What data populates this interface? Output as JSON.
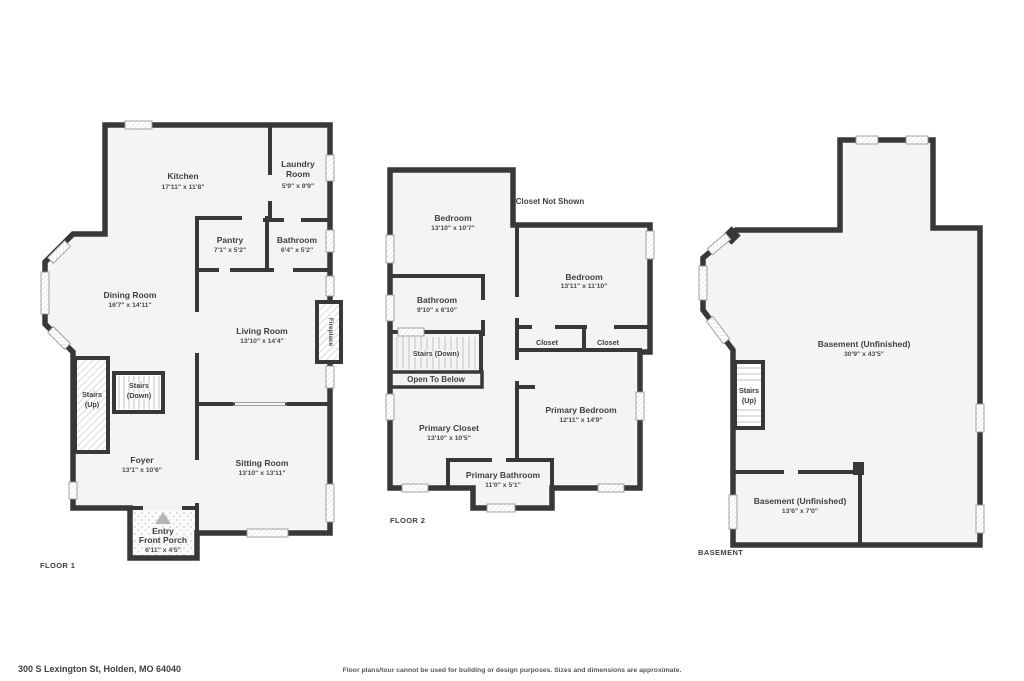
{
  "floor1": {
    "caption": "FLOOR 1",
    "kitchen": {
      "name": "Kitchen",
      "dims": "17'11\" x 11'8\""
    },
    "laundry": {
      "line1": "Laundry",
      "line2": "Room",
      "dims": "5'9\" x 9'9\""
    },
    "pantry": {
      "name": "Pantry",
      "dims": "7'1\" x 5'2\""
    },
    "bathroom": {
      "name": "Bathroom",
      "dims": "6'4\" x 5'2\""
    },
    "dining": {
      "name": "Dining Room",
      "dims": "16'7\" x 14'11\""
    },
    "living": {
      "name": "Living Room",
      "dims": "13'10\" x 14'4\""
    },
    "fireplace": {
      "name": "Fireplace"
    },
    "stairs_up": {
      "line1": "Stairs",
      "line2": "(Up)"
    },
    "stairs_down": {
      "line1": "Stairs",
      "line2": "(Down)"
    },
    "foyer": {
      "name": "Foyer",
      "dims": "13'1\" x 10'6\""
    },
    "sitting": {
      "name": "Sitting Room",
      "dims": "13'10\" x 13'11\""
    },
    "porch": {
      "line1": "Entry",
      "line2": "Front Porch",
      "dims": "6'11\" x 4'5\""
    }
  },
  "floor2": {
    "caption": "FLOOR 2",
    "bedroom1": {
      "name": "Bedroom",
      "dims": "13'10\" x 10'7\""
    },
    "closet_note": "Closet Not Shown",
    "bedroom2": {
      "name": "Bedroom",
      "dims": "13'11\" x 11'10\""
    },
    "bathroom": {
      "name": "Bathroom",
      "dims": "9'10\" x 6'10\""
    },
    "closet_a": "Closet",
    "closet_b": "Closet",
    "stairs_down": "Stairs (Down)",
    "open_below": "Open To Below",
    "primary_closet": {
      "name": "Primary Closet",
      "dims": "13'10\" x 10'5\""
    },
    "primary_bedroom": {
      "name": "Primary Bedroom",
      "dims": "12'11\" x 14'9\""
    },
    "primary_bathroom": {
      "name": "Primary Bathroom",
      "dims": "11'0\" x 5'1\""
    }
  },
  "basement": {
    "caption": "BASEMENT",
    "main": {
      "name": "Basement (Unfinished)",
      "dims": "30'9\" x 43'5\""
    },
    "stairs_up": {
      "line1": "Stairs",
      "line2": "(Up)"
    },
    "lower": {
      "name": "Basement (Unfinished)",
      "dims": "13'6\" x 7'0\""
    }
  },
  "footer": {
    "address": "300 S Lexington St, Holden, MO 64040",
    "disclaimer": "Floor plans/tour cannot be used for building or design purposes. Sizes and dimensions are approximate."
  }
}
